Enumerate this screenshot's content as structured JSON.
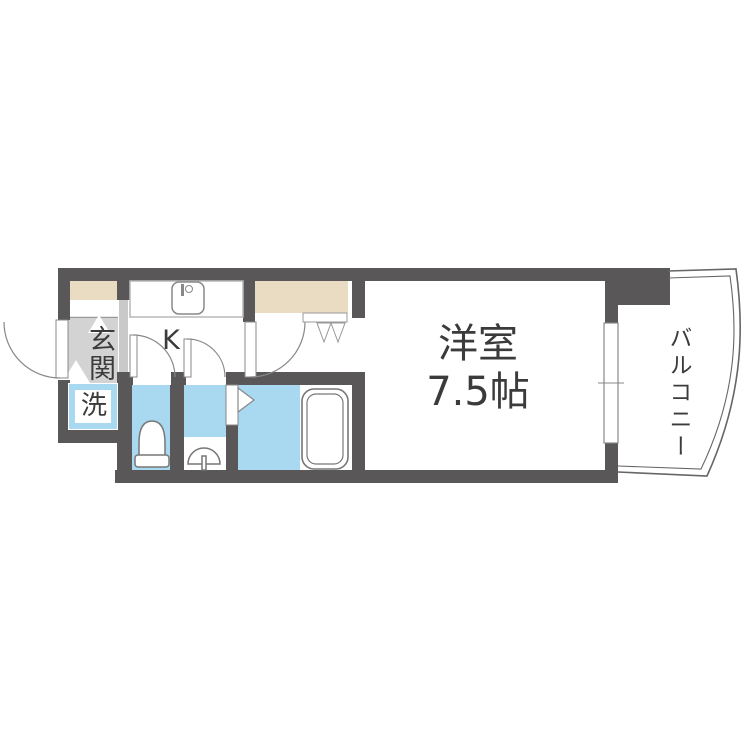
{
  "plan": {
    "rooms": {
      "entrance": "玄関",
      "laundry": "洗",
      "kitchen": "K",
      "main_room_name": "洋室",
      "main_room_size": "7.5帖",
      "balcony": "バルコニー"
    },
    "colors": {
      "wall": "#595757",
      "water_blue": "#a9d9f1",
      "closet_beige": "#e9dcc3",
      "entrance_floor_gray": "#d4d3d3",
      "label_text": "#3b3b3b"
    }
  }
}
